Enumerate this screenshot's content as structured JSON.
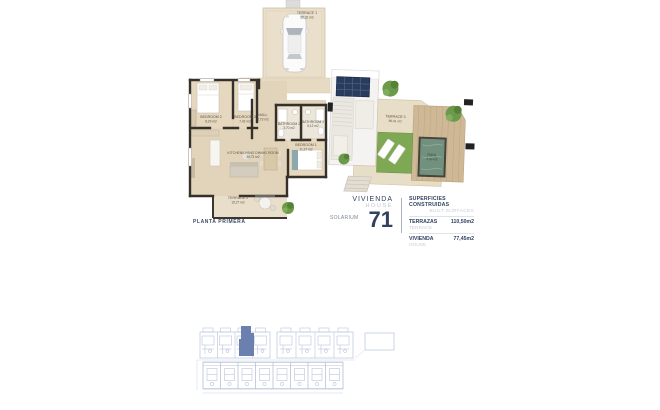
{
  "colors": {
    "navy": "#32415f",
    "muted_gray": "#bcc3ce",
    "highlight_blue": "#6379ab",
    "siteplan_line": "#b9c5da",
    "pool_water": "#71917e",
    "grass_green": "#7fa855",
    "wall_dark": "#35302a",
    "floor_beige": "#e2d4ba"
  },
  "floor_plan": {
    "caption": "PLANTA PRIMERA",
    "rooms": {
      "terrace1": {
        "label": "TERRACE 1",
        "area": "28,32 m2"
      },
      "bedroom2": {
        "label": "BEDROOM 2",
        "area": "8,29 m2"
      },
      "bedroom3": {
        "label": "BEDROOM 3",
        "area": "7,42 m2"
      },
      "hall": {
        "label": "HALL",
        "area": "2,73 m2"
      },
      "bathroom2": {
        "label": "BATHROOM 2",
        "area": "3,70 m2"
      },
      "bathroom1": {
        "label": "BATHROOM 1",
        "area": "5,12 m2"
      },
      "bedroom1": {
        "label": "BEDROOM 1",
        "area": "11,27 m2"
      },
      "kitchen": {
        "label": "KITCHEN/LIVING DINING ROOM",
        "area": "38,73 m2"
      },
      "terrace2": {
        "label": "TERRACE 2",
        "area": "15,27 m2"
      }
    }
  },
  "solarium_plan": {
    "caption": "SOLARIUM",
    "rooms": {
      "terrace3": {
        "label": "TERRACE 3",
        "area": "86,91 m2"
      },
      "pool": {
        "label": "POOL",
        "area": "6,86 m2"
      }
    }
  },
  "title_block": {
    "vivienda": "VIVIENDA",
    "house": "HOUSE",
    "number": "71",
    "surfaces": {
      "header_es": "SUPERFICIES CONSTRUIDAS",
      "header_en": "BUILT SURFACES",
      "rows": [
        {
          "label_es": "TERRAZAS",
          "label_en": "TERRACE",
          "value": "110,50m2"
        },
        {
          "label_es": "VIVIENDA",
          "label_en": "HOUSE",
          "value": "77,45m2"
        }
      ]
    }
  }
}
